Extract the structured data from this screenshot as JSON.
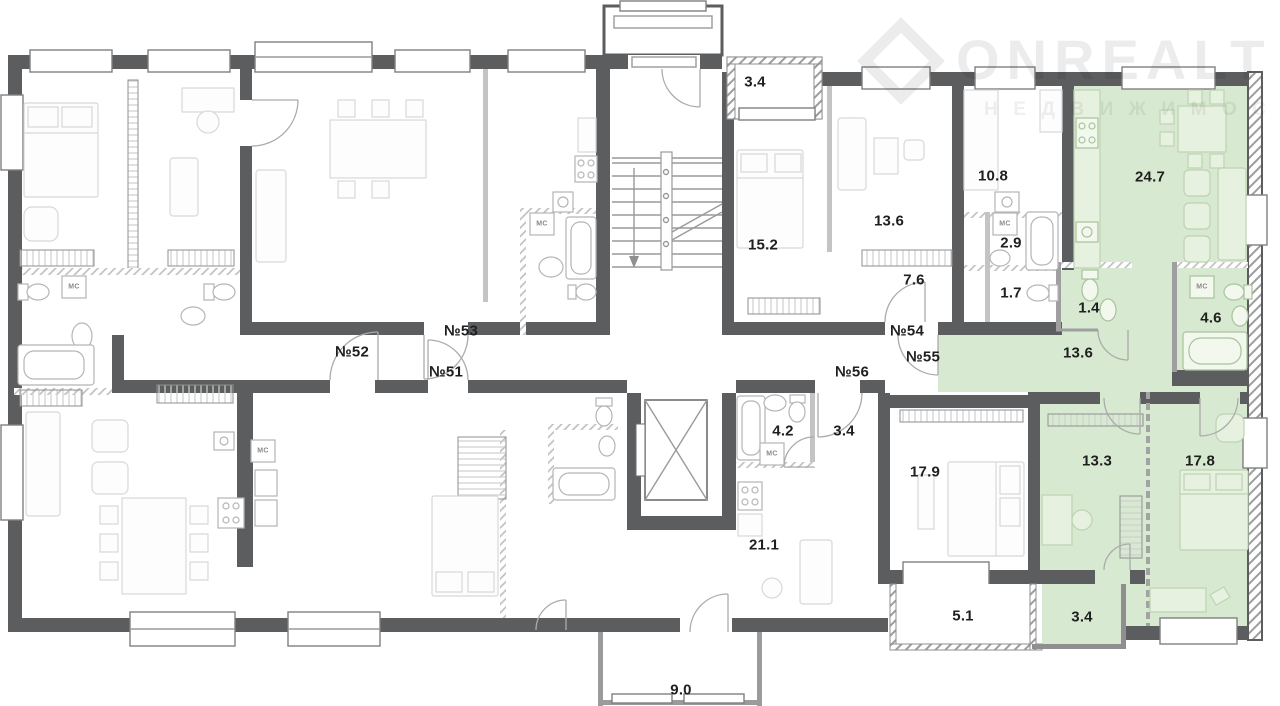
{
  "watermark": {
    "brand": "ONREALT",
    "subtitle": "НЕДВИЖИМОСТЬ"
  },
  "colors": {
    "highlight": "#d7e9d0",
    "wall": "#5c5d5f"
  },
  "legend": {
    "appliance_label": "МС"
  },
  "units": [
    {
      "label": "№52"
    },
    {
      "label": "№53"
    },
    {
      "label": "№51"
    },
    {
      "label": "№54"
    },
    {
      "label": "№55"
    },
    {
      "label": "№56"
    }
  ],
  "areas": [
    {
      "value": "3.4"
    },
    {
      "value": "15.2"
    },
    {
      "value": "13.6"
    },
    {
      "value": "7.6"
    },
    {
      "value": "10.8"
    },
    {
      "value": "2.9"
    },
    {
      "value": "1.7"
    },
    {
      "value": "24.7"
    },
    {
      "value": "1.4"
    },
    {
      "value": "4.6"
    },
    {
      "value": "13.6"
    },
    {
      "value": "13.3"
    },
    {
      "value": "17.8"
    },
    {
      "value": "4.2"
    },
    {
      "value": "3.4"
    },
    {
      "value": "17.9"
    },
    {
      "value": "21.1"
    },
    {
      "value": "5.1"
    },
    {
      "value": "3.4"
    },
    {
      "value": "9.0"
    }
  ]
}
